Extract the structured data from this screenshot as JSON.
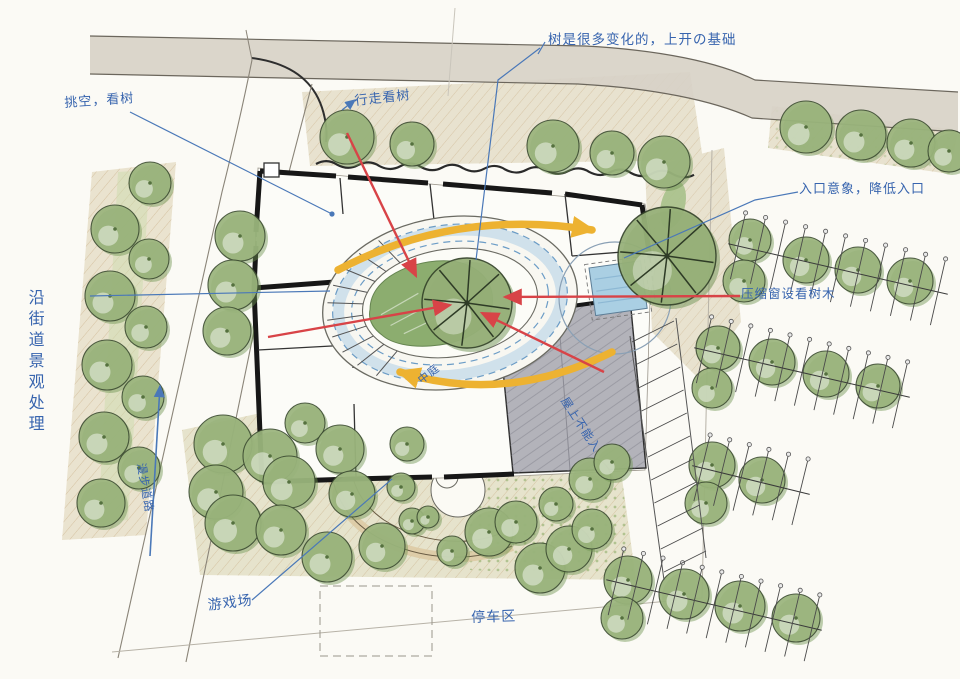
{
  "annotations": {
    "tree_note": "树是很多变化的，上开の基础",
    "walk_note": "行走看树",
    "void_note": "挑空，看树",
    "entrance_note": "入口意象，降低入口",
    "window_note": "压缩窗设看树木",
    "street_note": "沿街道景观处理",
    "path_note": "漫步道路",
    "playground_note": "游戏场",
    "parking_note": "停车区",
    "courtyard_note": "中庭",
    "roof_note": "屋上不能入"
  },
  "colors": {
    "ink_blue": "#3764ae",
    "ink_red": "#d84347",
    "arrow_yellow": "#edb231",
    "tree_green": "#93b176",
    "water_blue": "#aacfe3",
    "road_gray": "#d7d2c6",
    "roof_gray": "#b3b3ba"
  }
}
